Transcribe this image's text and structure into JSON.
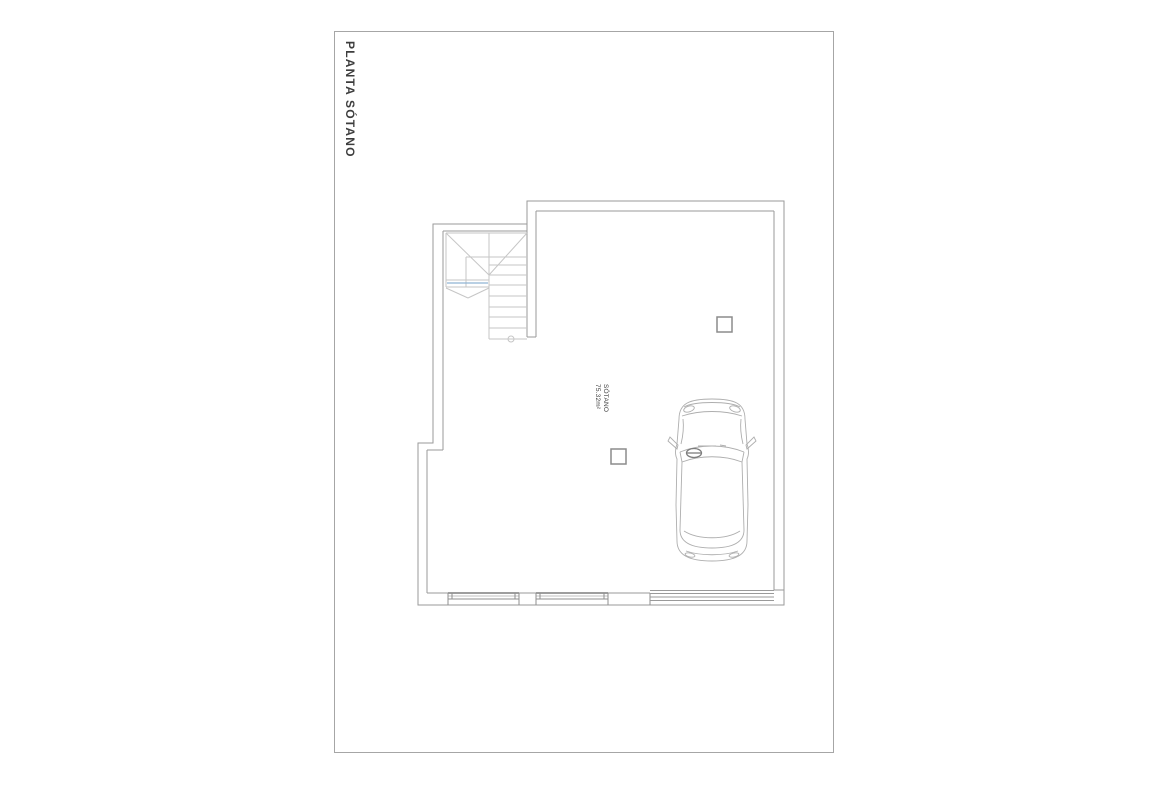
{
  "sheet": {
    "title": "PLANTA SÓTANO"
  },
  "plan": {
    "room_label": "SÓTANO",
    "room_area": "75.32m²"
  },
  "colors": {
    "background": "#ffffff",
    "line": "#a6a6a6",
    "wall": "#9a9a9a",
    "stair_line": "#c6c6c6",
    "accent_blue": "#8fb3d4",
    "text": "#3d3d3d"
  }
}
